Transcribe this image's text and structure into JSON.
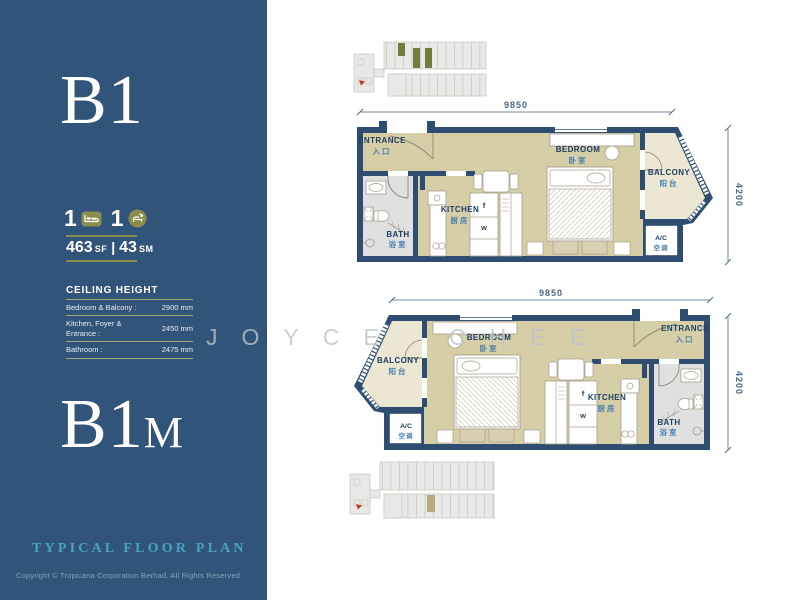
{
  "watermark": {
    "text": "JOYCE CHEE"
  },
  "sidebar": {
    "background_color": "#31547A",
    "accent_olive": "#8B8D4F",
    "title_teal": "#47A3C4",
    "unit_top": "B1",
    "unit_bottom_main": "B1",
    "unit_bottom_suffix": "M",
    "bedroom_count": "1",
    "bathroom_count": "1",
    "area_sf": "463",
    "area_sf_unit": "SF",
    "area_divider": "|",
    "area_sm": "43",
    "area_sm_unit": "SM",
    "ceiling": {
      "title": "CEILING HEIGHT",
      "rows": [
        {
          "label": "Bedroom & Balcony :",
          "value": "2900 mm"
        },
        {
          "label": "Kitchen, Foyer & Entrance :",
          "value": "2450 mm"
        },
        {
          "label": "Bathroom :",
          "value": "2475 mm"
        }
      ]
    },
    "footer_title": "TYPICAL FLOOR PLAN",
    "copyright": "Copyright © Tropicana Corporation Berhad. All Rights Reserved"
  },
  "plans": {
    "b1": {
      "label": "B1",
      "dims": {
        "width": "9850",
        "depth": "4200"
      },
      "rooms": {
        "entrance": {
          "en": "ENTRANCE",
          "zh": "入口"
        },
        "bedroom": {
          "en": "BEDROOM",
          "zh": "卧室"
        },
        "balcony": {
          "en": "BALCONY",
          "zh": "阳台"
        },
        "kitchen": {
          "en": "KITCHEN",
          "zh": "厨房"
        },
        "bath": {
          "en": "BATH",
          "zh": "浴室"
        },
        "ac": {
          "en": "A/C",
          "zh": "空调"
        }
      },
      "appliances": {
        "fridge": "f",
        "washer": "w"
      }
    },
    "b1m": {
      "label": "B1M",
      "dims": {
        "width": "9850",
        "depth": "4200"
      },
      "rooms": {
        "entrance": {
          "en": "ENTRANCE",
          "zh": "入口"
        },
        "bedroom": {
          "en": "BEDROOM",
          "zh": "卧室"
        },
        "balcony": {
          "en": "BALCONY",
          "zh": "阳台"
        },
        "kitchen": {
          "en": "KITCHEN",
          "zh": "厨房"
        },
        "bath": {
          "en": "BATH",
          "zh": "浴室"
        },
        "ac": {
          "en": "A/C",
          "zh": "空调"
        }
      },
      "appliances": {
        "fridge": "f",
        "washer": "w"
      }
    }
  },
  "colors": {
    "wall_navy": "#2E4D70",
    "floor_tan": "#D6CEA6",
    "balcony_tan": "#ECE7D2",
    "bath_gray": "#E0E0E0",
    "label_navy": "#1F3F66",
    "label_zh_blue": "#4C80AE",
    "dim_color": "#4A6685",
    "keyplan_gray": "#E8E8E6",
    "keyplan_highlight_top": "#727C3C",
    "keyplan_highlight_bottom": "#B9A97B",
    "keyplan_arrow_red": "#C23B2A"
  }
}
